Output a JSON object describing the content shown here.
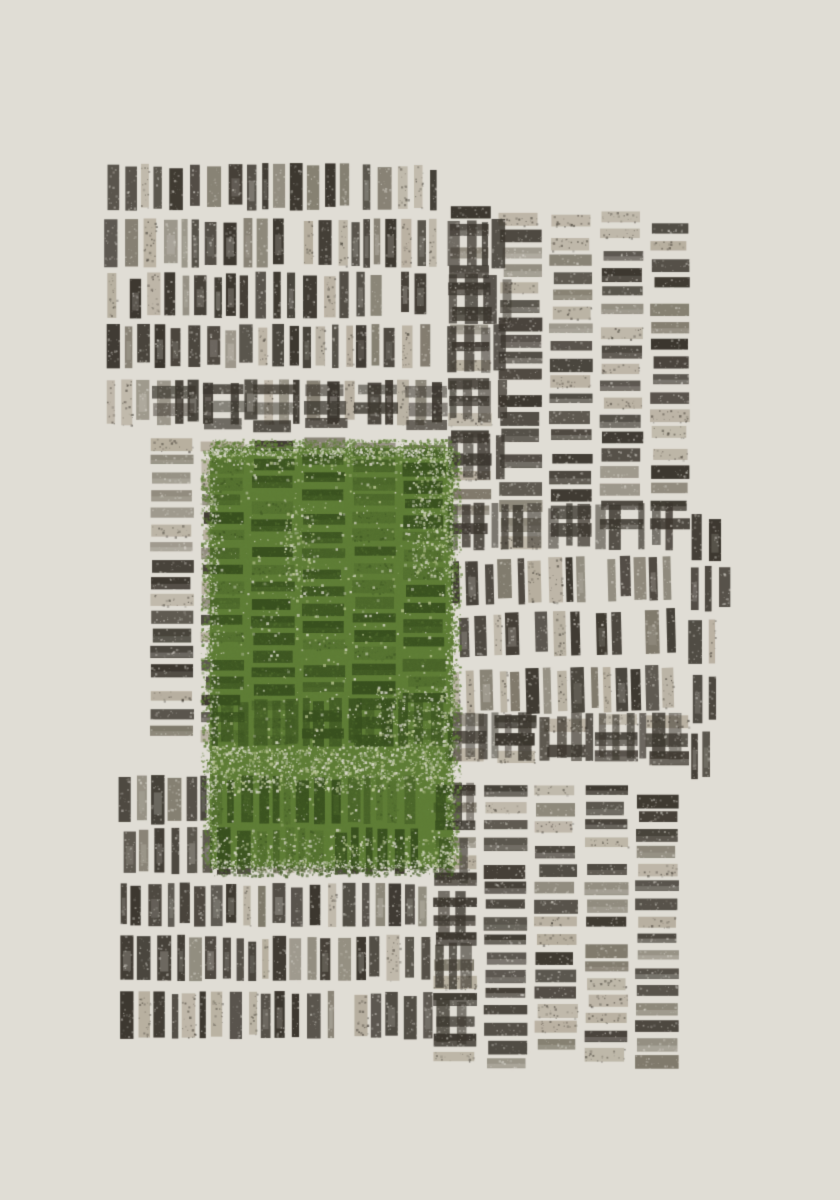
{
  "artwork": {
    "kind": "abstract-block-print",
    "canvas": {
      "width": 840,
      "height": 1200,
      "background": "#e0ddd5"
    },
    "palette": {
      "paper": "#e0ddd5",
      "ink_dark": "#3b362e",
      "ink_mid": "#746e5f",
      "ink_light": "#b6aE9e",
      "green_over_paper": "#5f7e36",
      "green_over_ink": "#38501e",
      "green_speckle": "#bcc795"
    },
    "geometry": {
      "row_pitch": 54.5,
      "row_height": 49,
      "stroke_w_min": 6,
      "stroke_w_max": 14,
      "stroke_gap_min": 3,
      "stroke_gap_max": 8,
      "col_pitch": 50.5,
      "col_width": 44,
      "slat_pitch": 17.4,
      "slat_h_min": 9,
      "slat_h_max": 14
    },
    "blocks": [
      {
        "name": "top-right-slat-columns",
        "type": "h",
        "x": 448,
        "y": 203,
        "w": 242,
        "h": 352,
        "seed": 101,
        "tj": 24,
        "bj": 20
      },
      {
        "name": "top-left-stroke-rows",
        "type": "v",
        "x": 103,
        "y": 162,
        "w": 345,
        "h": 272,
        "rows": 5,
        "seed": 102
      },
      {
        "name": "top-left-crosshatch-row",
        "type": "xh",
        "x": 152,
        "y": 384,
        "w": 296,
        "h": 50,
        "seed": 103,
        "tj": 2,
        "bj": 2
      },
      {
        "name": "top-overlap-crosshatch",
        "type": "xv",
        "x": 447,
        "y": 217,
        "w": 75,
        "h": 288,
        "rows": 5,
        "seed": 104
      },
      {
        "name": "mid-left-slat-columns",
        "type": "h",
        "x": 150,
        "y": 437,
        "w": 305,
        "h": 315,
        "seed": 105,
        "tj": 10,
        "bj": 10
      },
      {
        "name": "mid-left-crosshatch-band",
        "type": "xv",
        "x": 208,
        "y": 697,
        "w": 247,
        "h": 55,
        "rows": 1,
        "seed": 106
      },
      {
        "name": "mid-right-crosshatch-band-upper",
        "type": "xv",
        "x": 443,
        "y": 503,
        "w": 247,
        "h": 54,
        "rows": 1,
        "seed": 107
      },
      {
        "name": "mid-right-stroke-rows",
        "type": "v",
        "x": 448,
        "y": 557,
        "w": 240,
        "h": 156,
        "rows": 3,
        "tilt": -1.4,
        "seed": 108
      },
      {
        "name": "mid-right-stroke-column",
        "type": "v",
        "x": 688,
        "y": 512,
        "w": 45,
        "h": 268,
        "rows": 5,
        "seed": 109
      },
      {
        "name": "mid-right-crosshatch-band-lower",
        "type": "x",
        "x": 443,
        "y": 713,
        "w": 247,
        "h": 62,
        "rows": 1,
        "seed": 110,
        "tj": 3,
        "bj": 3
      },
      {
        "name": "bottom-left-stroke-rows",
        "type": "v",
        "x": 118,
        "y": 773,
        "w": 325,
        "h": 272,
        "rows": 5,
        "seed": 111
      },
      {
        "name": "bottom-right-slat-columns",
        "type": "h",
        "x": 433,
        "y": 780,
        "w": 257,
        "h": 303,
        "seed": 112,
        "tj": 8,
        "bj": 14
      },
      {
        "name": "bottom-right-crosshatch-strip",
        "type": "xv",
        "x": 433,
        "y": 780,
        "w": 50,
        "h": 265,
        "rows": 5,
        "seed": 113
      }
    ],
    "green_overlay": {
      "x": 210,
      "y": 448,
      "w": 243,
      "h": 420,
      "seed": 200,
      "speckle_bands": [
        {
          "x": 212,
          "y": 745,
          "w": 239,
          "h": 46,
          "d": 0.5
        },
        {
          "x": 412,
          "y": 452,
          "w": 40,
          "h": 125,
          "d": 0.4
        },
        {
          "x": 212,
          "y": 449,
          "w": 239,
          "h": 16,
          "d": 0.3
        },
        {
          "x": 212,
          "y": 836,
          "w": 239,
          "h": 30,
          "d": 0.25
        },
        {
          "x": 284,
          "y": 505,
          "w": 30,
          "h": 95,
          "d": 0.22
        },
        {
          "x": 376,
          "y": 688,
          "w": 76,
          "h": 58,
          "d": 0.3
        },
        {
          "x": 210,
          "y": 448,
          "w": 243,
          "h": 420,
          "d": 0.04
        }
      ]
    }
  }
}
